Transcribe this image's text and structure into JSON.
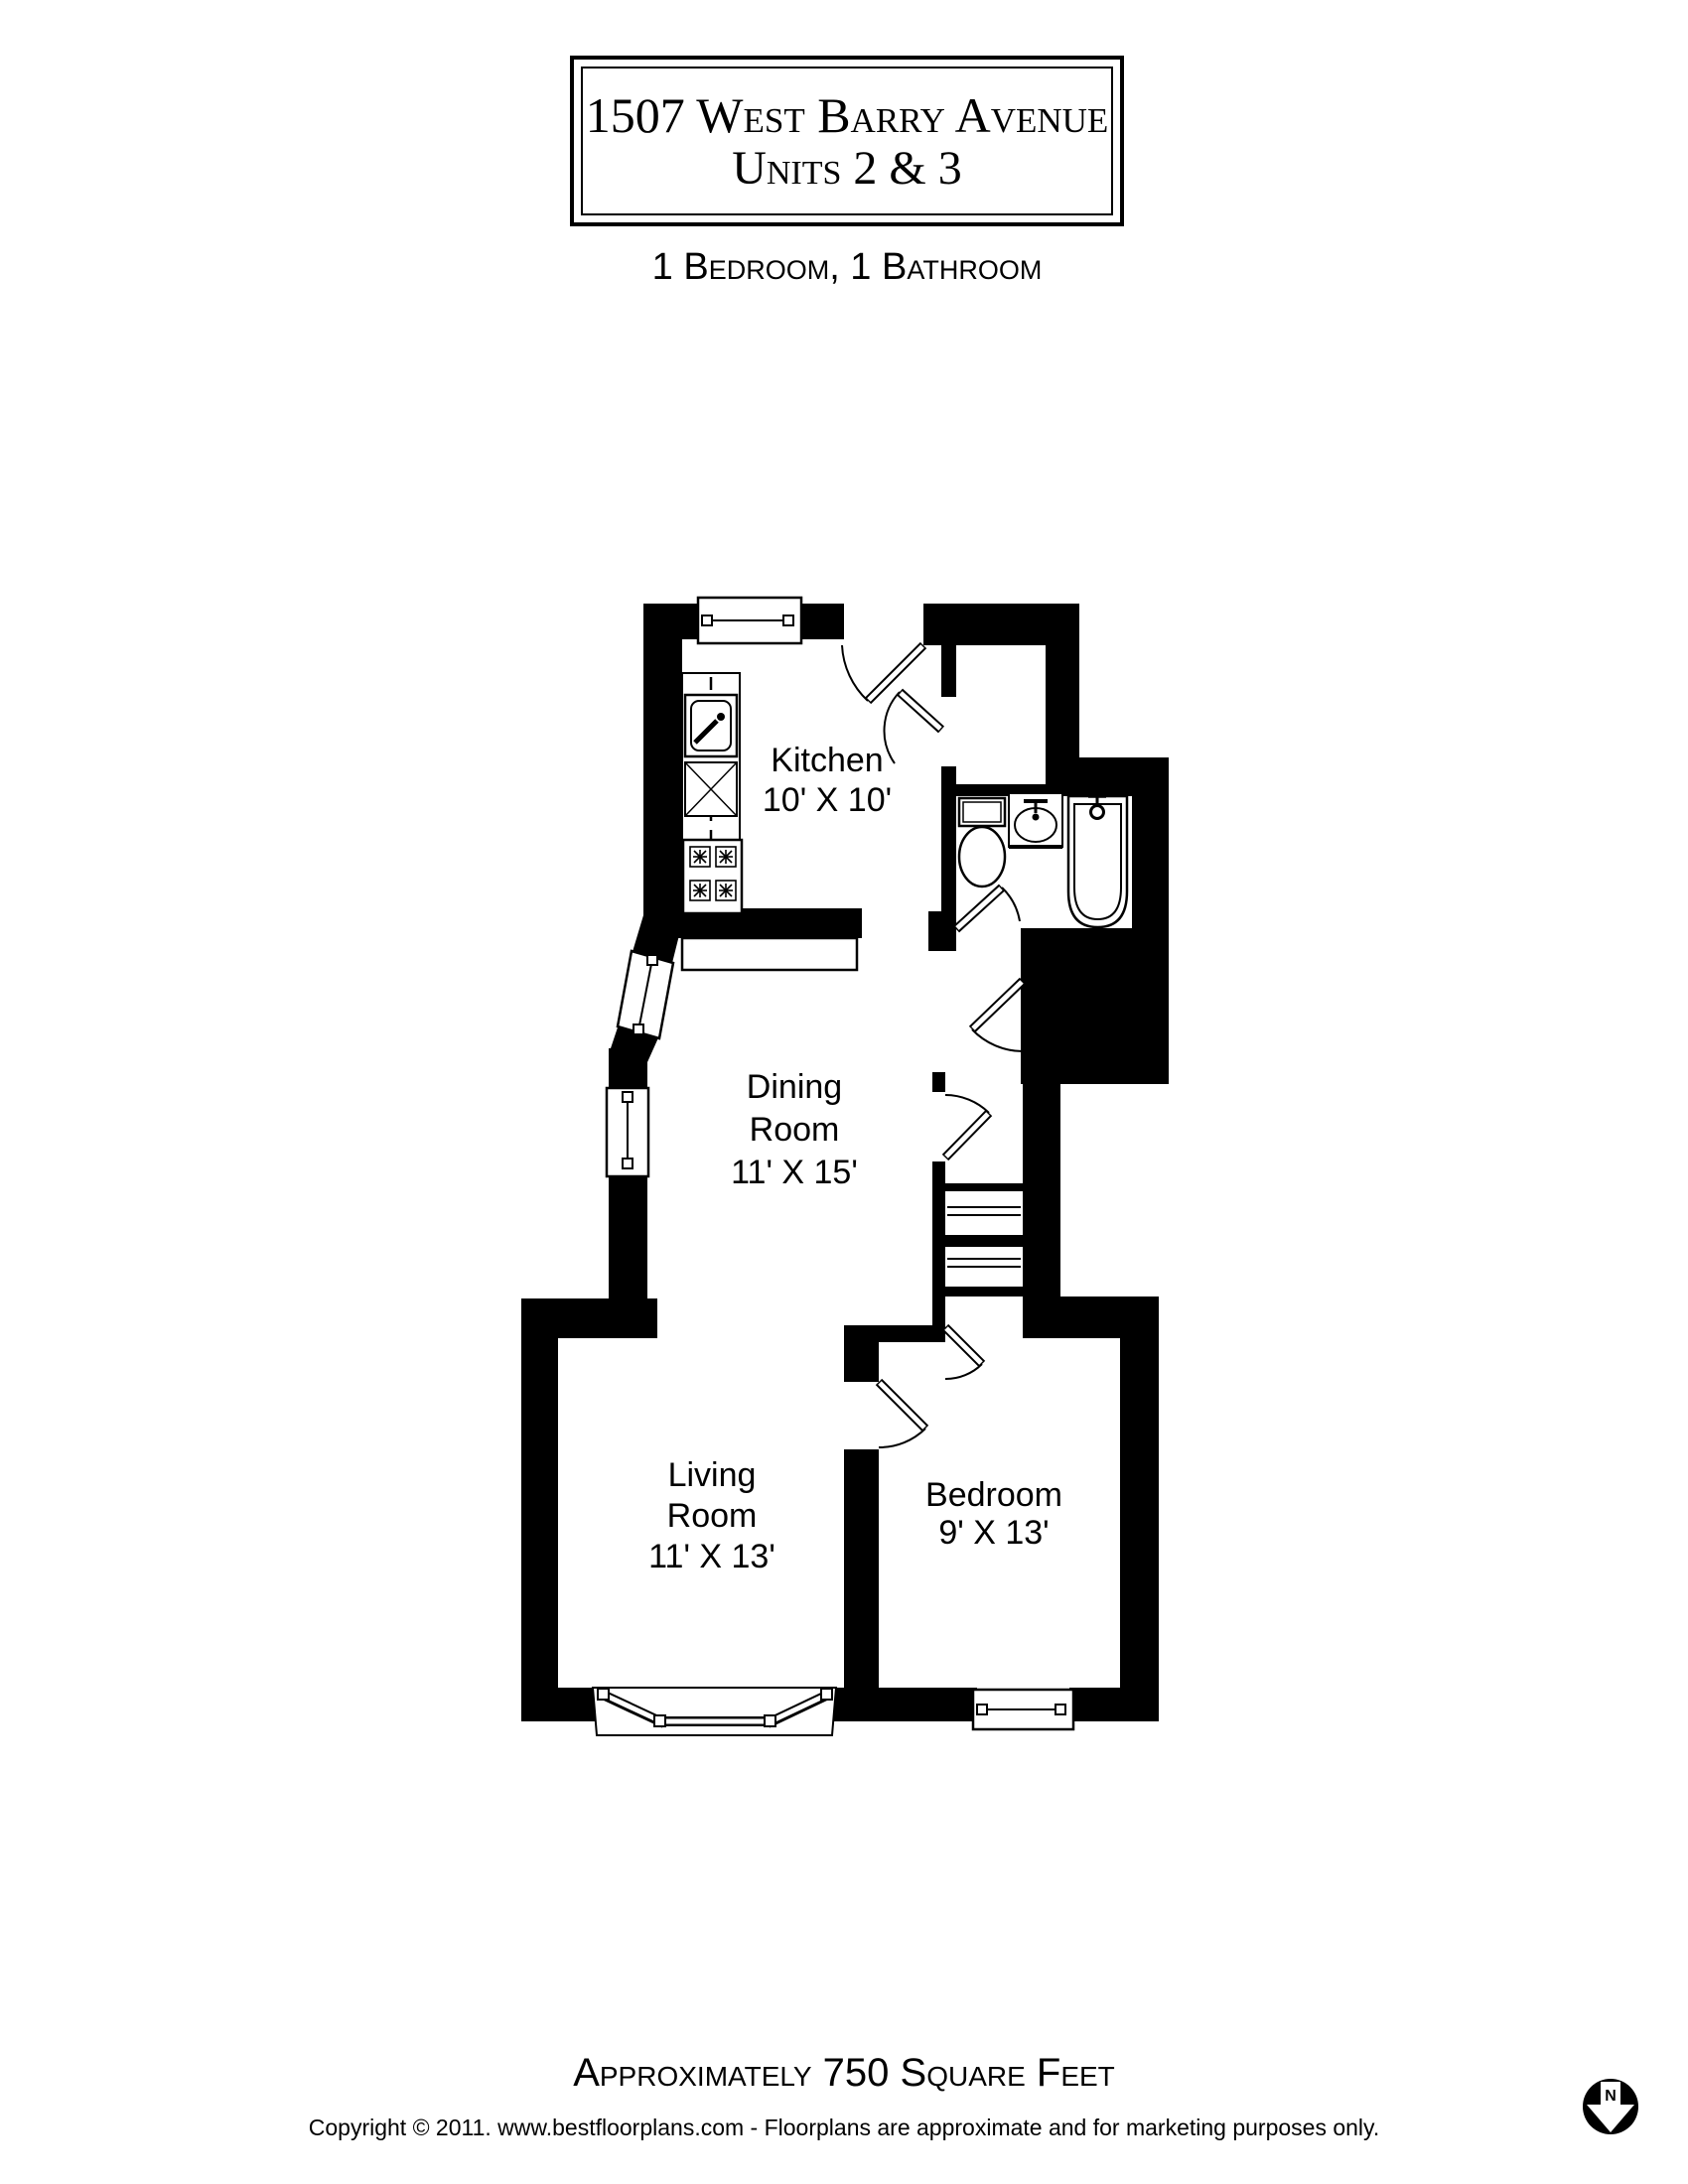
{
  "title": {
    "line1": "1507 West Barry Avenue",
    "line2": "Units 2 & 3"
  },
  "subtitle": "1 Bedroom, 1 Bathroom",
  "rooms": {
    "kitchen": {
      "name": "Kitchen",
      "dims": "10' X 10'"
    },
    "dining": {
      "name_line1": "Dining",
      "name_line2": "Room",
      "dims": "11' X 15'"
    },
    "living": {
      "name_line1": "Living",
      "name_line2": "Room",
      "dims": "11' X 13'"
    },
    "bedroom": {
      "name": "Bedroom",
      "dims": "9' X 13'"
    }
  },
  "footer": {
    "area_text": "Approximately 750 Square Feet",
    "copyright": "Copyright © 2011. www.bestfloorplans.com - Floorplans are approximate and for marketing purposes only."
  },
  "compass": {
    "letter": "N"
  },
  "colors": {
    "wall": "#000000",
    "background": "#ffffff",
    "text": "#000000"
  }
}
